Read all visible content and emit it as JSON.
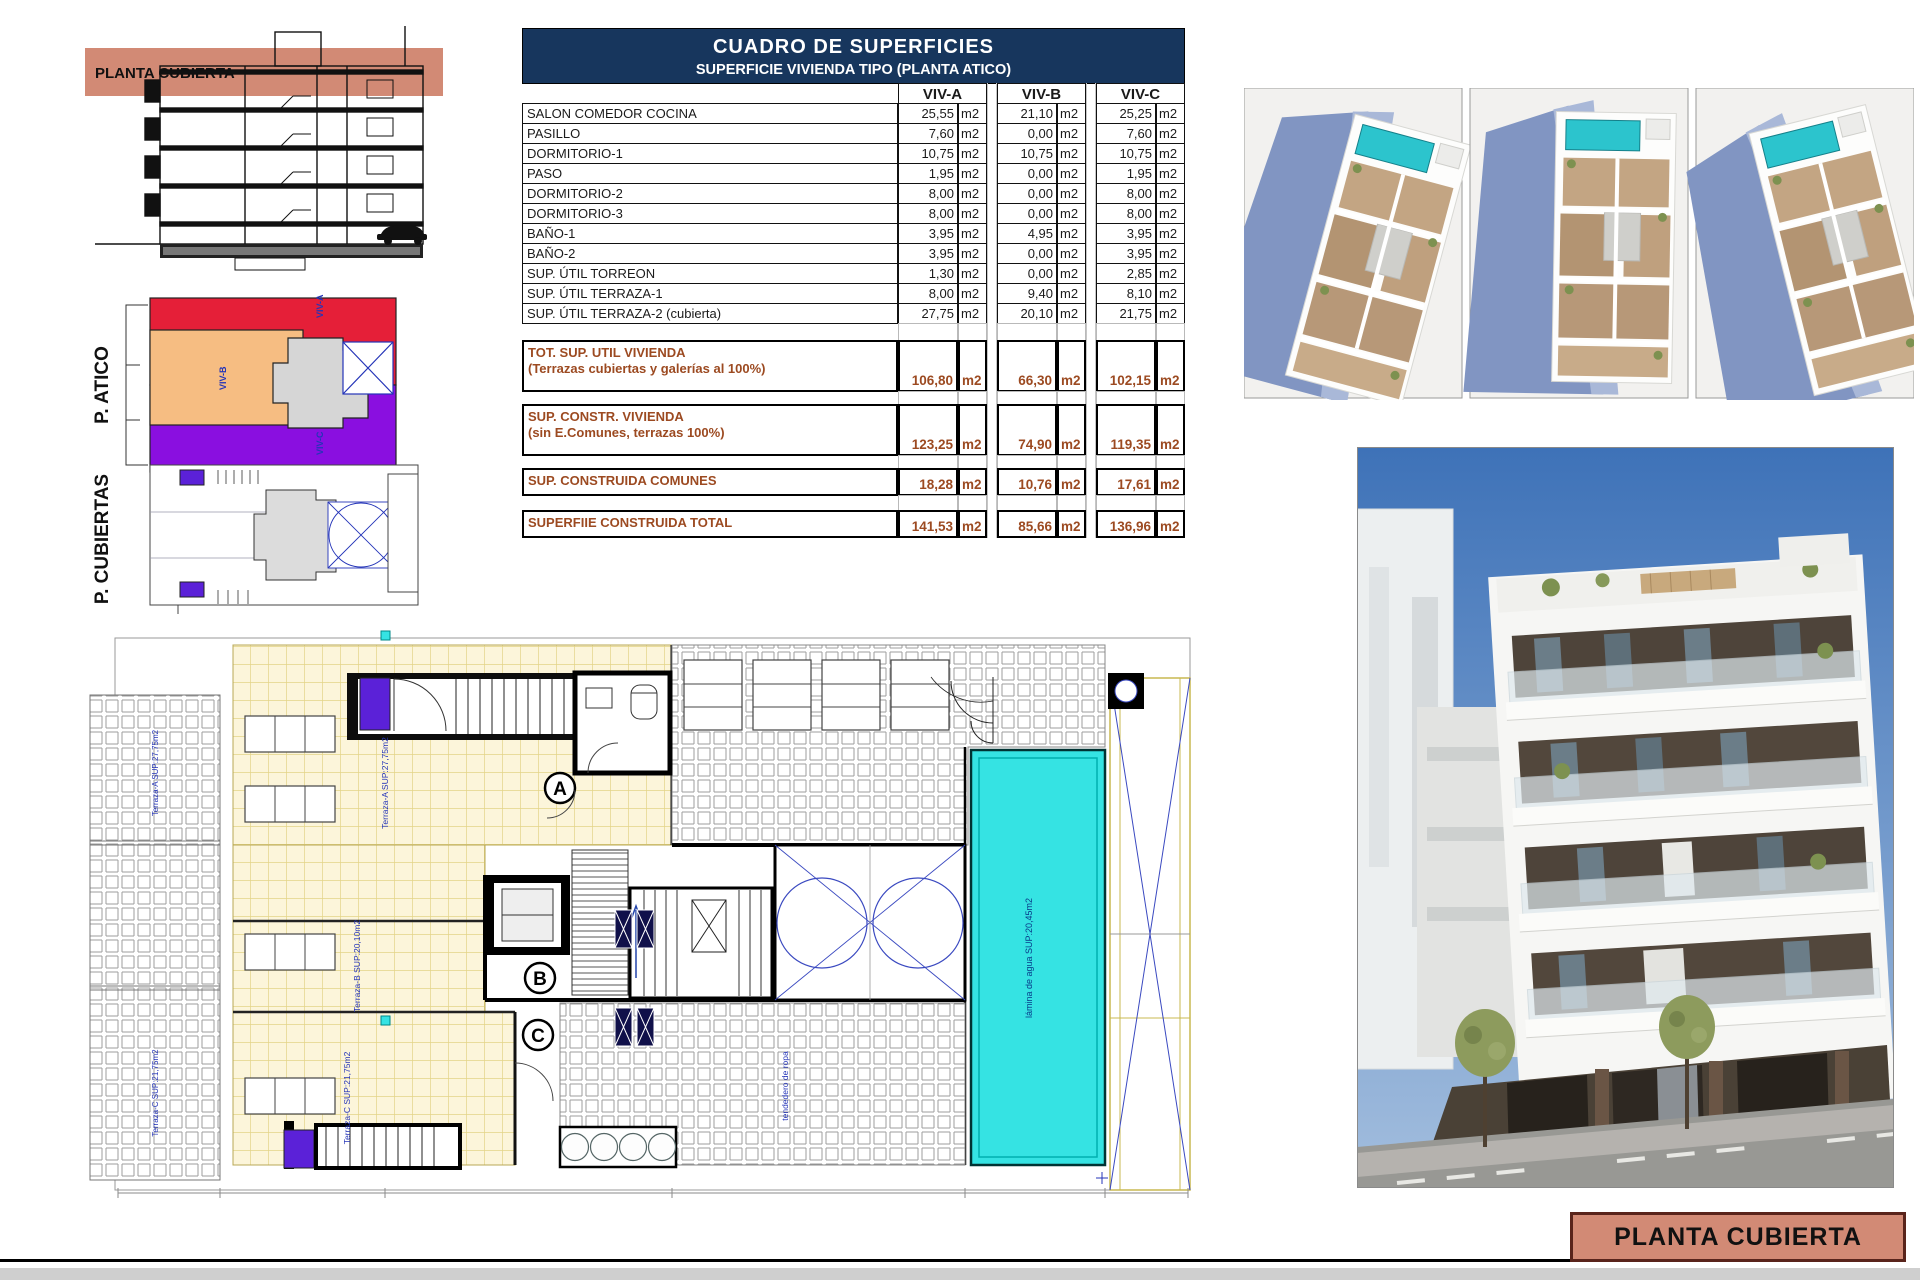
{
  "table": {
    "title": "CUADRO DE SUPERFICIES",
    "subtitle": "SUPERFICIE VIVIENDA TIPO  (PLANTA ATICO)",
    "unit": "m2",
    "columns": [
      "VIV-A",
      "VIV-B",
      "VIV-C"
    ],
    "rows": [
      {
        "label": "SALON COMEDOR COCINA",
        "viv_a": "25,55",
        "viv_b": "21,10",
        "viv_c": "25,25"
      },
      {
        "label": "PASILLO",
        "viv_a": "7,60",
        "viv_b": "0,00",
        "viv_c": "7,60"
      },
      {
        "label": "DORMITORIO-1",
        "viv_a": "10,75",
        "viv_b": "10,75",
        "viv_c": "10,75"
      },
      {
        "label": "PASO",
        "viv_a": "1,95",
        "viv_b": "0,00",
        "viv_c": "1,95"
      },
      {
        "label": "DORMITORIO-2",
        "viv_a": "8,00",
        "viv_b": "0,00",
        "viv_c": "8,00"
      },
      {
        "label": "DORMITORIO-3",
        "viv_a": "8,00",
        "viv_b": "0,00",
        "viv_c": "8,00"
      },
      {
        "label": "BAÑO-1",
        "viv_a": "3,95",
        "viv_b": "4,95",
        "viv_c": "3,95"
      },
      {
        "label": "BAÑO-2",
        "viv_a": "3,95",
        "viv_b": "0,00",
        "viv_c": "3,95"
      },
      {
        "label": "SUP. ÚTIL TORREON",
        "viv_a": "1,30",
        "viv_b": "0,00",
        "viv_c": "2,85"
      },
      {
        "label": "SUP. ÚTIL TERRAZA-1",
        "viv_a": "8,00",
        "viv_b": "9,40",
        "viv_c": "8,10"
      },
      {
        "label": "SUP. ÚTIL TERRAZA-2 (cubierta)",
        "viv_a": "27,75",
        "viv_b": "20,10",
        "viv_c": "21,75"
      }
    ],
    "totals": [
      {
        "label": "TOT. SUP. UTIL VIVIENDA",
        "sublabel": "(Terrazas cubiertas y galerías al 100%)",
        "viv_a": "106,80",
        "viv_b": "66,30",
        "viv_c": "102,15"
      },
      {
        "label": "SUP. CONSTR. VIVIENDA",
        "sublabel": "(sin E.Comunes, terrazas 100%)",
        "viv_a": "123,25",
        "viv_b": "74,90",
        "viv_c": "119,35"
      },
      {
        "label": "SUP. CONSTRUIDA COMUNES",
        "sublabel": "",
        "viv_a": "18,28",
        "viv_b": "10,76",
        "viv_c": "17,61"
      },
      {
        "label": "SUPERFIIE CONSTRUIDA TOTAL",
        "sublabel": "",
        "viv_a": "141,53",
        "viv_b": "85,66",
        "viv_c": "136,96"
      }
    ]
  },
  "drawings": {
    "section_band_label": "PLANTA CUBIERTA",
    "atico_label": "P. ATICO",
    "cubiertas_label": "P. CUBIERTAS",
    "atico_viv_a": "VIV-A",
    "atico_viv_b": "VIV-B",
    "atico_viv_c": "VIV-C"
  },
  "plan": {
    "terraza_a": "Terraza-A SUP:27,75m2",
    "terraza_b": "Terraza-B SUP:20,10m2",
    "terraza_c": "Terraza-C SUP:21,75m2",
    "pool": "lámina de agua SUP:20,45m2",
    "laundry": "tendedero de ropa",
    "marker_a": "A",
    "marker_b": "B",
    "marker_c": "C"
  },
  "footer": {
    "label": "PLANTA CUBIERTA"
  },
  "colors": {
    "table_header_navy": "#17365d",
    "totals_brown": "#9c4a21",
    "salmon_band": "#d28a75",
    "pool_cyan": "#35e3e3",
    "atico_red": "#e51f38",
    "atico_purple": "#8a0fe0",
    "atico_orange": "#f6bd82",
    "cad_blue": "#2434b8"
  }
}
